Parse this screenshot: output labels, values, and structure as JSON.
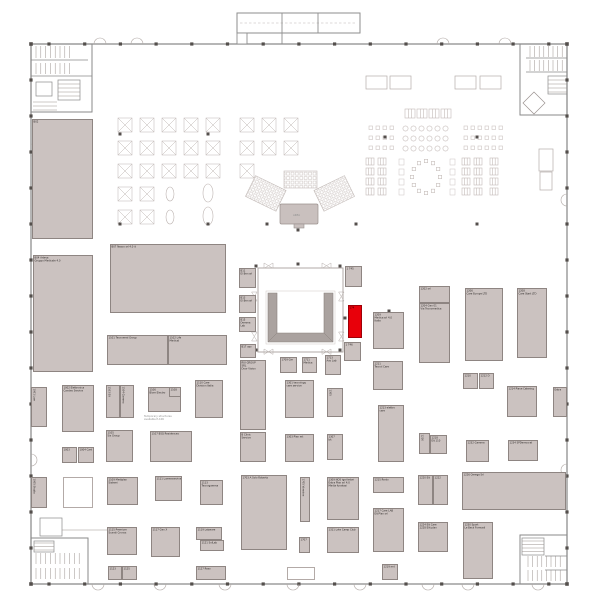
{
  "plan": {
    "colors": {
      "background": "#ffffff",
      "wall": "#8e8e8e",
      "column": "#544f4c",
      "booth_fill": "#cbc2c0",
      "booth_border": "#8e8582",
      "highlight": "#e8000a",
      "furniture": "#c3bab7",
      "pavilion_wall": "#aaa29f"
    },
    "selected_booth": {
      "id": "174"
    },
    "annotations": [
      {
        "text": "Temporary structures\navailable P-106",
        "x": 144,
        "y": 417
      },
      {
        "text": "AREA",
        "x": 293,
        "y": 216
      }
    ],
    "booths": [
      {
        "id": "B02",
        "label": "B02",
        "x": 32,
        "y": 119,
        "w": 61,
        "h": 120
      },
      {
        "id": "B04",
        "label": "B04 Arteva\nGruppo Medicale 4.0",
        "x": 33,
        "y": 255,
        "w": 60,
        "h": 117
      },
      {
        "id": "1001",
        "label": "1001 Lum",
        "x": 31,
        "y": 387,
        "w": 16,
        "h": 40,
        "variant": "vert"
      },
      {
        "id": "1002",
        "label": "1002 Elettronica\nCandeo Service",
        "x": 62,
        "y": 385,
        "w": 32,
        "h": 47
      },
      {
        "id": "1003",
        "label": "1003",
        "x": 62,
        "y": 447,
        "w": 15,
        "h": 16
      },
      {
        "id": "1004",
        "label": "1004 Cart",
        "x": 78,
        "y": 447,
        "w": 16,
        "h": 16
      },
      {
        "id": "1005",
        "label": "1005 Studio",
        "x": 31,
        "y": 477,
        "w": 16,
        "h": 31,
        "variant": "vert"
      },
      {
        "id": "1006",
        "label": "",
        "x": 63,
        "y": 477,
        "w": 30,
        "h": 31,
        "variant": "white"
      },
      {
        "id": "B07",
        "label": "B07 Nasco srl 4.0 it",
        "x": 110,
        "y": 244,
        "w": 116,
        "h": 69
      },
      {
        "id": "1101",
        "label": "1101 Tecnomed Group",
        "x": 107,
        "y": 335,
        "w": 61,
        "h": 30
      },
      {
        "id": "1102",
        "label": "1102 Life\nMedical",
        "x": 168,
        "y": 335,
        "w": 59,
        "h": 30
      },
      {
        "id": "1103",
        "label": "1103 Elt",
        "x": 106,
        "y": 385,
        "w": 14,
        "h": 33,
        "variant": "vert"
      },
      {
        "id": "1104",
        "label": "1104 Gamma",
        "x": 120,
        "y": 385,
        "w": 14,
        "h": 33,
        "variant": "vert"
      },
      {
        "id": "1106",
        "label": "1106\nBlom Electro",
        "x": 148,
        "y": 387,
        "w": 33,
        "h": 25
      },
      {
        "id": "1108",
        "label": "1108",
        "x": 169,
        "y": 387,
        "w": 12,
        "h": 10
      },
      {
        "id": "1110",
        "label": "1110 Care\nDivision Italia",
        "x": 195,
        "y": 380,
        "w": 28,
        "h": 38
      },
      {
        "id": "1105",
        "label": "1105\nSix Group",
        "x": 106,
        "y": 430,
        "w": 27,
        "h": 32
      },
      {
        "id": "1107",
        "label": "1107 BSQ Residences",
        "x": 150,
        "y": 431,
        "w": 42,
        "h": 31
      },
      {
        "id": "1109",
        "label": "1109 Mediplan\nSistemi",
        "x": 107,
        "y": 477,
        "w": 31,
        "h": 28
      },
      {
        "id": "1111",
        "label": "1111 Lumenservice",
        "x": 155,
        "y": 476,
        "w": 27,
        "h": 25
      },
      {
        "id": "1113",
        "label": "1113\nTecnogamma",
        "x": 200,
        "y": 480,
        "w": 23,
        "h": 25
      },
      {
        "id": "1115",
        "label": "1115 Premium\nScandi Cronos",
        "x": 107,
        "y": 527,
        "w": 30,
        "h": 28
      },
      {
        "id": "1117",
        "label": "1117 Gen X",
        "x": 151,
        "y": 527,
        "w": 29,
        "h": 30
      },
      {
        "id": "1119",
        "label": "1119 Labware",
        "x": 196,
        "y": 527,
        "w": 26,
        "h": 13
      },
      {
        "id": "1121",
        "label": "1121 SolLab",
        "x": 200,
        "y": 540,
        "w": 24,
        "h": 11
      },
      {
        "id": "1123",
        "label": "1123",
        "x": 108,
        "y": 566,
        "w": 14,
        "h": 14
      },
      {
        "id": "1125",
        "label": "1125",
        "x": 122,
        "y": 566,
        "w": 15,
        "h": 14
      },
      {
        "id": "1127",
        "label": "1127 Rexo",
        "x": 196,
        "y": 566,
        "w": 30,
        "h": 14
      },
      {
        "id": "B11",
        "label": "B11\nEl Ben srl",
        "x": 239,
        "y": 268,
        "w": 17,
        "h": 20
      },
      {
        "id": "B13",
        "label": "B13\nEl Ben srl",
        "x": 239,
        "y": 295,
        "w": 17,
        "h": 18
      },
      {
        "id": "B15",
        "label": "B15\nDemma Lab",
        "x": 239,
        "y": 317,
        "w": 17,
        "h": 15
      },
      {
        "id": "B17",
        "label": "B17 azo",
        "x": 240,
        "y": 344,
        "w": 16,
        "h": 14
      },
      {
        "id": "RIU",
        "label": "RIU GROUP\nSRL\nDoor Vision",
        "x": 240,
        "y": 360,
        "w": 26,
        "h": 70
      },
      {
        "id": "BCL",
        "label": "B Clinic\nService",
        "x": 240,
        "y": 432,
        "w": 26,
        "h": 30
      },
      {
        "id": "1703",
        "label": "1703 A Solo Roberts",
        "x": 241,
        "y": 475,
        "w": 46,
        "h": 75
      },
      {
        "id": "1705",
        "label": "1705 Varesine",
        "x": 300,
        "y": 477,
        "w": 10,
        "h": 45,
        "variant": "vert"
      },
      {
        "id": "1707",
        "label": "1707",
        "x": 299,
        "y": 537,
        "w": 11,
        "h": 16
      },
      {
        "id": "1709",
        "label": "1709 Gm",
        "x": 280,
        "y": 357,
        "w": 17,
        "h": 16
      },
      {
        "id": "1711",
        "label": "1711\nMedica",
        "x": 302,
        "y": 357,
        "w": 15,
        "h": 16
      },
      {
        "id": "1713",
        "label": "1713\nAxo Lab",
        "x": 325,
        "y": 355,
        "w": 16,
        "h": 20
      },
      {
        "id": "1715",
        "label": "",
        "x": 287,
        "y": 567,
        "w": 28,
        "h": 13,
        "variant": "white"
      },
      {
        "id": "1745",
        "label": "1 745",
        "x": 345,
        "y": 266,
        "w": 17,
        "h": 21
      },
      {
        "id": "174",
        "label": "174",
        "x": 348,
        "y": 305,
        "w": 14,
        "h": 33,
        "variant": "selected"
      },
      {
        "id": "1746",
        "label": "1 746",
        "x": 344,
        "y": 342,
        "w": 17,
        "h": 19
      },
      {
        "id": "1209",
        "label": "1209\nMedica srl 4.0\nItalia",
        "x": 373,
        "y": 312,
        "w": 31,
        "h": 37
      },
      {
        "id": "1211",
        "label": "1211\nTecnol Care",
        "x": 373,
        "y": 361,
        "w": 30,
        "h": 29
      },
      {
        "id": "1213",
        "label": "1213 elettro\ncare",
        "x": 378,
        "y": 405,
        "w": 26,
        "h": 57
      },
      {
        "id": "1202",
        "label": "1202 srl",
        "x": 419,
        "y": 286,
        "w": 31,
        "h": 17
      },
      {
        "id": "1204",
        "label": "1204 Gen 01\nVia Tecnomedica",
        "x": 419,
        "y": 303,
        "w": 31,
        "h": 60
      },
      {
        "id": "1206",
        "label": "1206\nCare Europe LTD",
        "x": 465,
        "y": 288,
        "w": 38,
        "h": 73
      },
      {
        "id": "1208",
        "label": "1208\nCare Start LTD",
        "x": 517,
        "y": 288,
        "w": 30,
        "h": 70
      },
      {
        "id": "1210",
        "label": "1210",
        "x": 463,
        "y": 373,
        "w": 15,
        "h": 16
      },
      {
        "id": "1212",
        "label": "1212 D",
        "x": 479,
        "y": 373,
        "w": 15,
        "h": 16
      },
      {
        "id": "1214",
        "label": "1214 Piave Catering",
        "x": 507,
        "y": 386,
        "w": 30,
        "h": 31
      },
      {
        "id": "EXT",
        "label": "Extra",
        "x": 553,
        "y": 387,
        "w": 14,
        "h": 30
      },
      {
        "id": "1216",
        "label": "1216",
        "x": 419,
        "y": 433,
        "w": 11,
        "h": 21,
        "variant": "vert"
      },
      {
        "id": "1218",
        "label": "1218\nElt 110",
        "x": 430,
        "y": 435,
        "w": 17,
        "h": 19
      },
      {
        "id": "1232",
        "label": "1232 Gamma",
        "x": 466,
        "y": 440,
        "w": 23,
        "h": 22
      },
      {
        "id": "1234",
        "label": "1234 SPDemocrat",
        "x": 508,
        "y": 440,
        "w": 30,
        "h": 21
      },
      {
        "id": "1220",
        "label": "1220 Elt",
        "x": 418,
        "y": 475,
        "w": 15,
        "h": 30
      },
      {
        "id": "1222",
        "label": "1222",
        "x": 433,
        "y": 475,
        "w": 15,
        "h": 30
      },
      {
        "id": "1226",
        "label": "1226 Omega Srl",
        "x": 462,
        "y": 472,
        "w": 104,
        "h": 38
      },
      {
        "id": "1224",
        "label": "1224 Elt Care\n1228 Elit plan",
        "x": 418,
        "y": 522,
        "w": 30,
        "h": 30
      },
      {
        "id": "1230",
        "label": "1230 Sport\nLe Beck Formadi",
        "x": 463,
        "y": 522,
        "w": 30,
        "h": 57
      },
      {
        "id": "1215",
        "label": "1215 Renlo",
        "x": 373,
        "y": 477,
        "w": 31,
        "h": 16
      },
      {
        "id": "1217",
        "label": "1217 Care LAB\nElt Plan srl",
        "x": 373,
        "y": 508,
        "w": 31,
        "h": 44
      },
      {
        "id": "1219",
        "label": "1219 md",
        "x": 382,
        "y": 564,
        "w": 16,
        "h": 16
      },
      {
        "id": "1301",
        "label": "1301 tecnology\ncare service",
        "x": 285,
        "y": 380,
        "w": 29,
        "h": 38
      },
      {
        "id": "1303",
        "label": "1303 Plan mt",
        "x": 285,
        "y": 434,
        "w": 29,
        "h": 28
      },
      {
        "id": "1305",
        "label": "1305",
        "x": 327,
        "y": 388,
        "w": 16,
        "h": 29,
        "variant": "vert"
      },
      {
        "id": "1307",
        "label": "1307\nbk",
        "x": 327,
        "y": 434,
        "w": 16,
        "h": 26
      },
      {
        "id": "1309",
        "label": "1309 NOS iga fartori\nExtra Plan srl 4.0\nMedia furakasi",
        "x": 327,
        "y": 477,
        "w": 32,
        "h": 43
      },
      {
        "id": "1311",
        "label": "1311 Lote Camp Club",
        "x": 327,
        "y": 527,
        "w": 32,
        "h": 26
      }
    ]
  }
}
